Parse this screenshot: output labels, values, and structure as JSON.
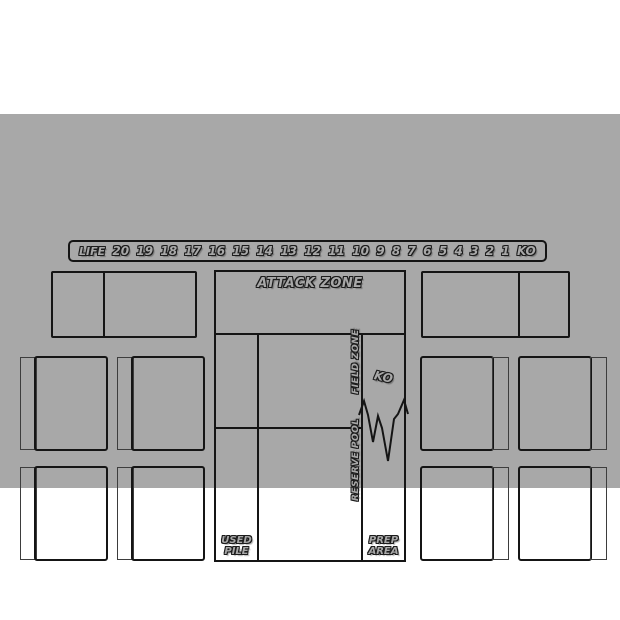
{
  "colors": {
    "page_background": "#ffffff",
    "mat_background": "#a8a8a8",
    "line": "#151515",
    "strip_line": "#3d3d3d",
    "label_fill": "#a8a8a8",
    "label_outline": "#1c1c1c"
  },
  "life_track": {
    "label": "LIFE",
    "values": [
      "20",
      "19",
      "18",
      "17",
      "16",
      "15",
      "14",
      "13",
      "12",
      "11",
      "10",
      "9",
      "8",
      "7",
      "6",
      "5",
      "4",
      "3",
      "2",
      "1",
      "KO"
    ]
  },
  "center_panel": {
    "attack_zone_label": "ATTACK ZONE",
    "field_zone_label": "FIELD ZONE",
    "reserve_pool_label": "RESERVE POOL",
    "ko_label": "KO",
    "used_pile_line1": "USED",
    "used_pile_line2": "PILE",
    "prep_area_line1": "PREP",
    "prep_area_line2": "AREA"
  }
}
